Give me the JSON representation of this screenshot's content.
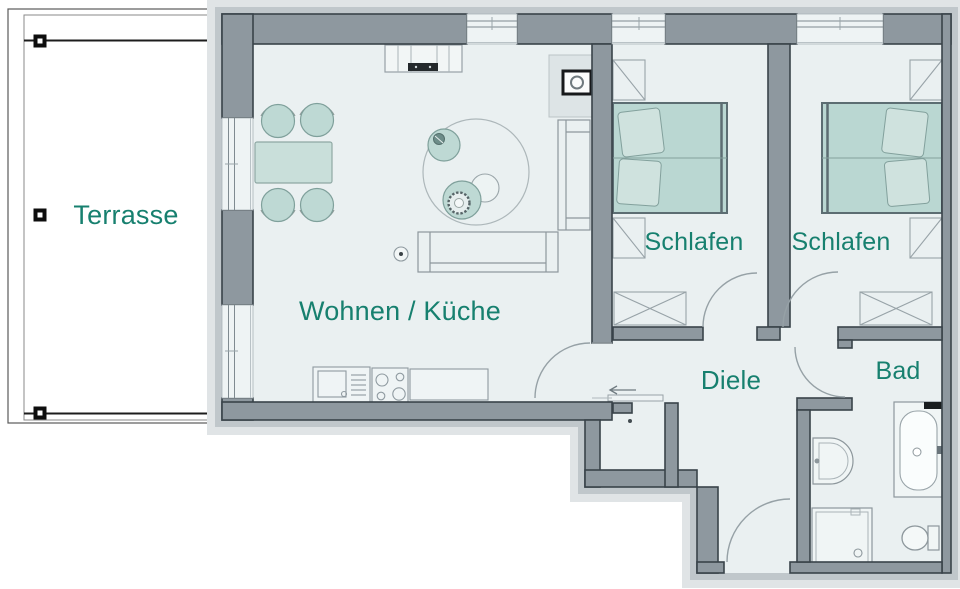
{
  "title": "Apartment floor plan",
  "rooms": {
    "terrasse": {
      "label": "Terrasse"
    },
    "wohnen_kueche": {
      "label": "Wohnen / Küche"
    },
    "schlafen_1": {
      "label": "Schlafen"
    },
    "schlafen_2": {
      "label": "Schlafen"
    },
    "diele": {
      "label": "Diele"
    },
    "bad": {
      "label": "Bad"
    }
  },
  "colors": {
    "label_text": "#17806F",
    "wall_fill": "#8E989F",
    "wall_outline": "#39434A",
    "floor_fill": "#EAF0F1",
    "furniture_teal": "#BED9D4",
    "facade_band_inner": "#C0C7CB",
    "facade_band_outer": "#E0E4E6"
  },
  "furniture_icons": [
    "dining-table",
    "dining-chair",
    "round-rug",
    "lounge-chair",
    "wicker-chair",
    "side-table",
    "sofa",
    "floor-lamp",
    "tv-sideboard",
    "wood-stove",
    "kitchen-sink",
    "cooktop",
    "kitchen-counter",
    "double-bed",
    "wardrobe",
    "chest",
    "washbasin",
    "shower",
    "bathtub",
    "toilet",
    "terrace-post",
    "entrance-arrow",
    "sliding-door",
    "door-swing"
  ]
}
